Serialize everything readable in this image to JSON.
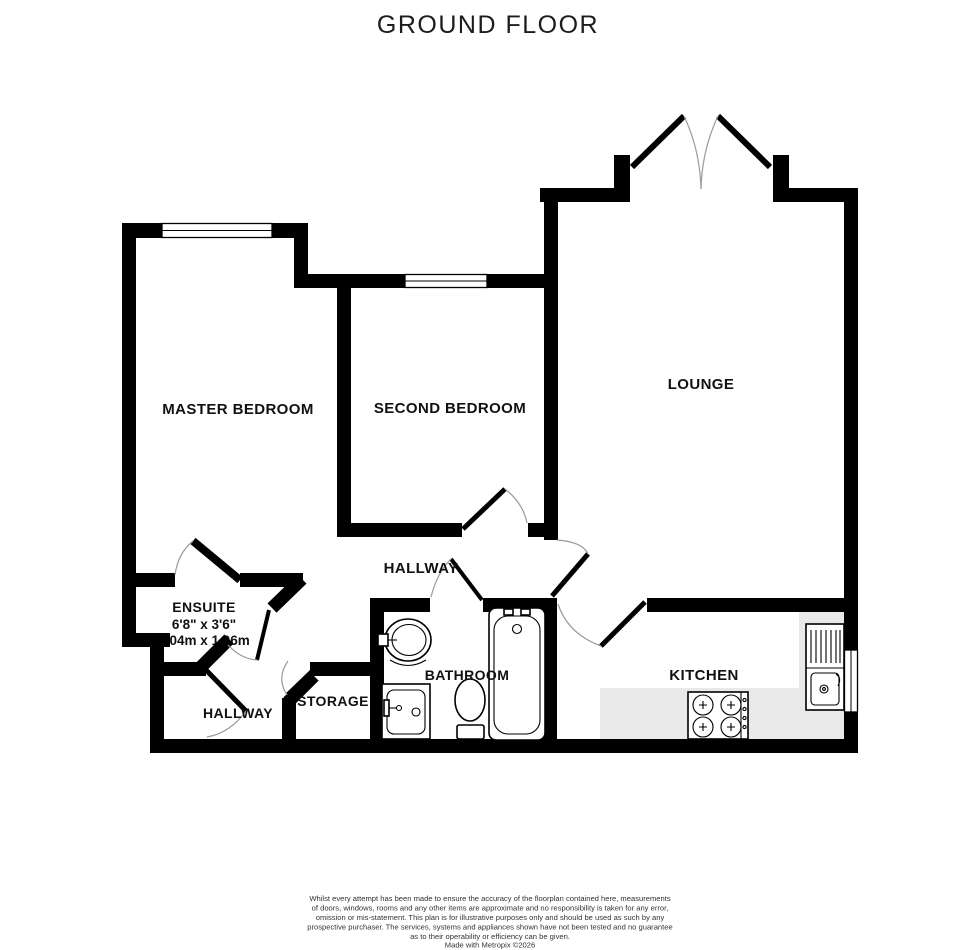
{
  "title": "GROUND FLOOR",
  "rooms": {
    "master_bedroom": "MASTER BEDROOM",
    "second_bedroom": "SECOND BEDROOM",
    "lounge": "LOUNGE",
    "hallway_upper": "HALLWAY",
    "ensuite": "ENSUITE",
    "ensuite_dims_imperial": "6'8\"  x 3'6\"",
    "ensuite_dims_metric": "2.04m  x 1.06m",
    "hallway_lower": "HALLWAY",
    "storage": "STORAGE",
    "bathroom": "BATHROOM",
    "kitchen": "KITCHEN"
  },
  "colors": {
    "wall": "#000000",
    "counter": "#e9e9e9",
    "door_arc": "#9a9a9a",
    "text": "#111111"
  },
  "footer": {
    "lines": [
      "Whilst every attempt has been made to ensure the accuracy of the floorplan contained here, measurements",
      "of doors, windows, rooms and any other items are approximate and no responsibility is taken for any error,",
      "omission or mis-statement. This plan is for illustrative purposes only and should be used as such by any",
      "prospective purchaser. The services, systems and appliances shown have not been tested and no guarantee",
      "as to their operability or efficiency can be given.",
      "Made with Metropix ©2026"
    ]
  }
}
